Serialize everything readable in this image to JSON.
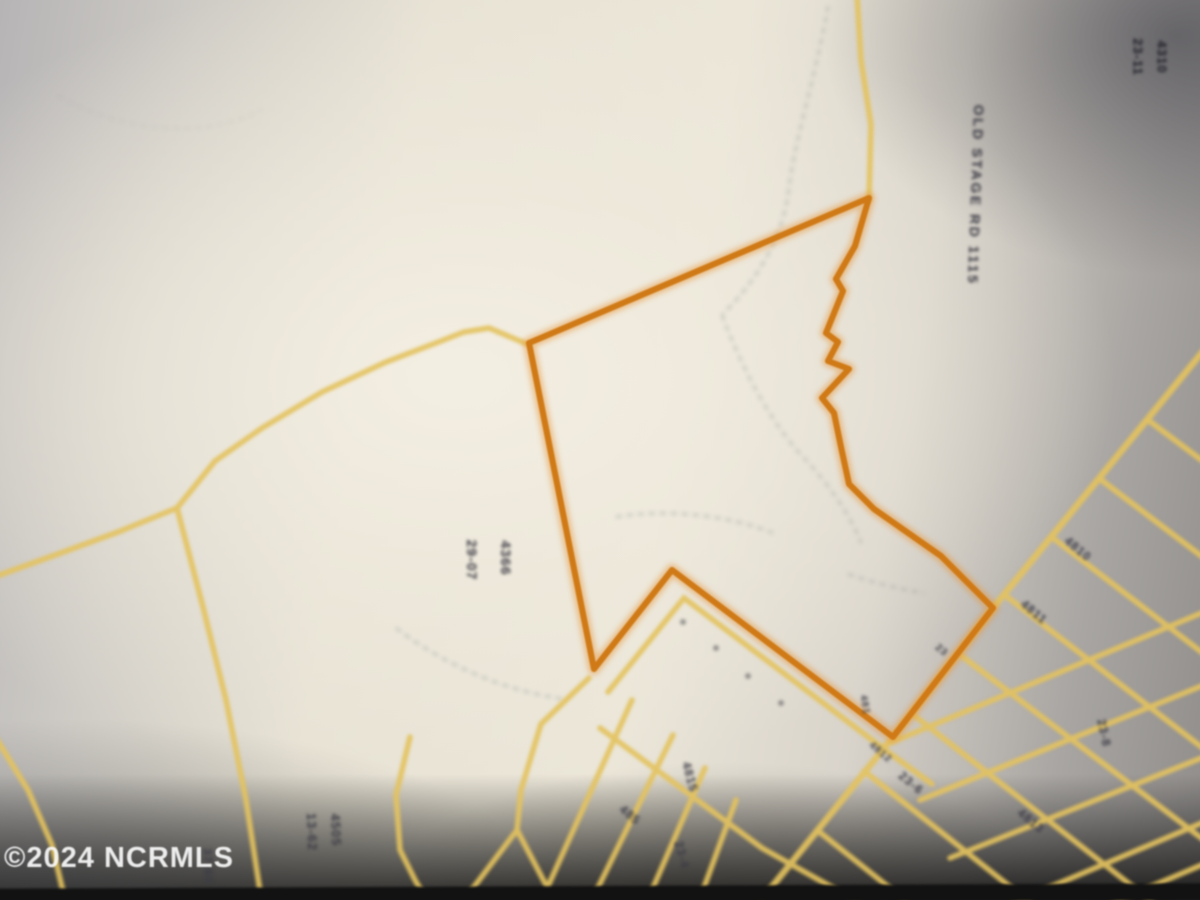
{
  "map": {
    "description": "Blurry photographed county plat / parcel map with one parcel outlined in orange",
    "watermark": {
      "text": "©2024 NCRMLS"
    },
    "road_name_label": {
      "text": "OLD STAGE RD 1115"
    },
    "colors": {
      "highlight_parcel": "#cf7a16",
      "parcel_lines": "#e3c25f",
      "paper": "#ebe6d8",
      "label_ink": "#3c3b45",
      "watermark": "#fafafa",
      "photo_edge": "#121212"
    },
    "small_labels": [
      {
        "text": "29-07"
      },
      {
        "text": "4366"
      },
      {
        "text": "13-62"
      },
      {
        "text": "4505"
      },
      {
        "text": "37-80"
      },
      {
        "text": "23-11"
      },
      {
        "text": "4310"
      },
      {
        "text": "4810"
      },
      {
        "text": "4811"
      },
      {
        "text": "23"
      },
      {
        "text": "481"
      },
      {
        "text": "4812"
      },
      {
        "text": "4815"
      },
      {
        "text": "23-4"
      },
      {
        "text": "485"
      },
      {
        "text": "23-6"
      },
      {
        "text": "4813"
      },
      {
        "text": "23-8"
      }
    ]
  }
}
